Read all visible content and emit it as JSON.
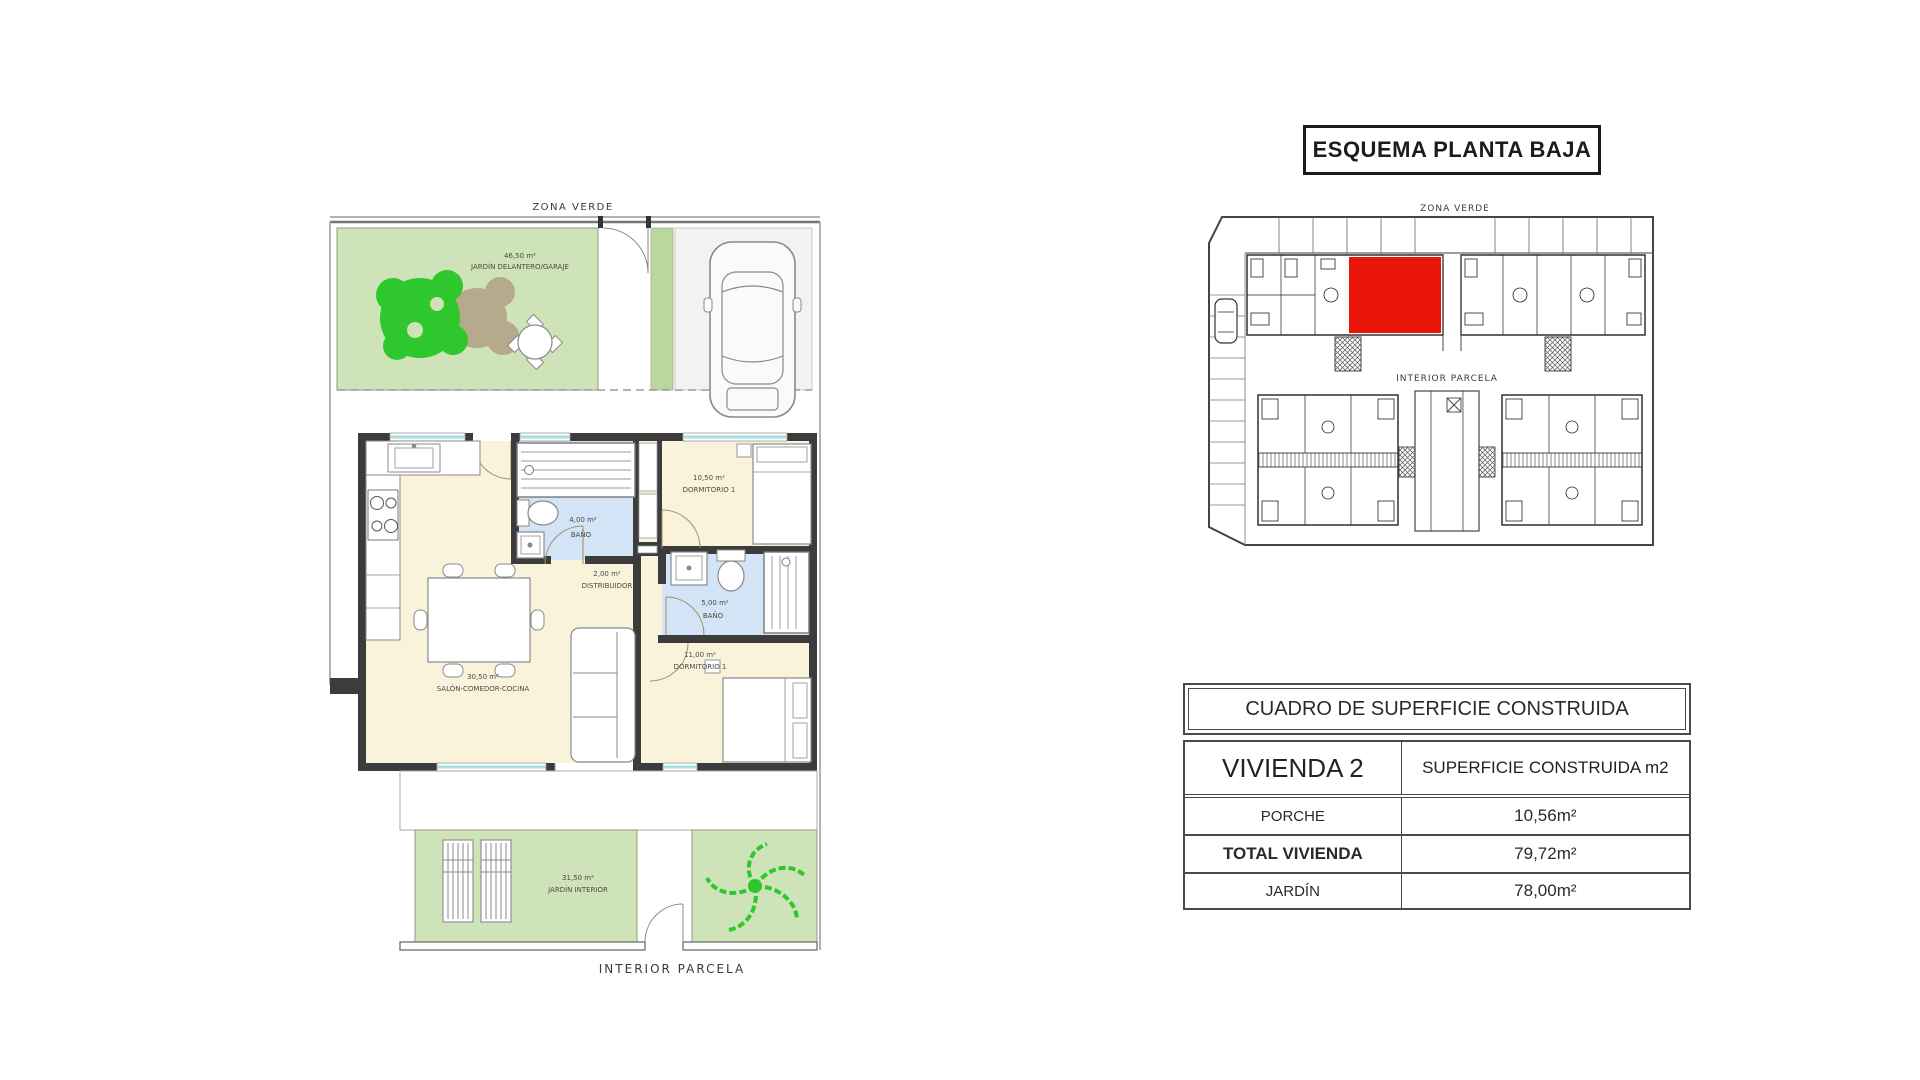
{
  "main_plan": {
    "zona_verde": "ZONA VERDE",
    "interior_parcela": "INTERIOR PARCELA",
    "front_garden": {
      "area": "46,50 m²",
      "name": "JARDÍN DELANTERO/GARAJE"
    },
    "bath1": {
      "area": "4,00 m²",
      "name": "BAÑO"
    },
    "bedroom1": {
      "area": "10,50 m²",
      "name": "DORMITORIO 1"
    },
    "hall": {
      "area": "2,00 m²",
      "name": "DISTRIBUIDOR"
    },
    "bath2": {
      "area": "5,00 m²",
      "name": "BAÑO"
    },
    "bedroom2": {
      "area": "11,00 m²",
      "name": "DORMITORIO 1"
    },
    "living": {
      "area": "30,50 m²",
      "name": "SALÓN-COMEDOR-COCINA"
    },
    "inner_garden": {
      "area": "31,50 m²",
      "name": "JARDÍN INTERIOR"
    }
  },
  "schematic": {
    "title": "ESQUEMA PLANTA BAJA",
    "zona_verde": "ZONA VERDE",
    "interior_parcela": "INTERIOR PARCELA",
    "highlight_color": "#e81508"
  },
  "surface_table": {
    "title": "CUADRO DE SUPERFICIE CONSTRUIDA",
    "col1_header": "VIVIENDA 2",
    "col2_header": "SUPERFICIE CONSTRUIDA m2",
    "rows": [
      {
        "label": "PORCHE",
        "value": "10,56m²"
      },
      {
        "label": "TOTAL VIVIENDA",
        "value": "79,72m²"
      },
      {
        "label": "JARDÍN",
        "value": "78,00m²"
      }
    ]
  },
  "colors": {
    "garden_green": "#cfe3b8",
    "strip_green": "#b9d89e",
    "tree_green": "#2ec82e",
    "shrub_brown": "#b5aa8c",
    "floor_beige": "#faf3dc",
    "bath_blue": "#d2e4f5",
    "wall_dark": "#3c3c3c",
    "window_cyan": "#a8dde2",
    "garage_gray": "#f2f2f2",
    "highlight_red": "#e81508"
  }
}
